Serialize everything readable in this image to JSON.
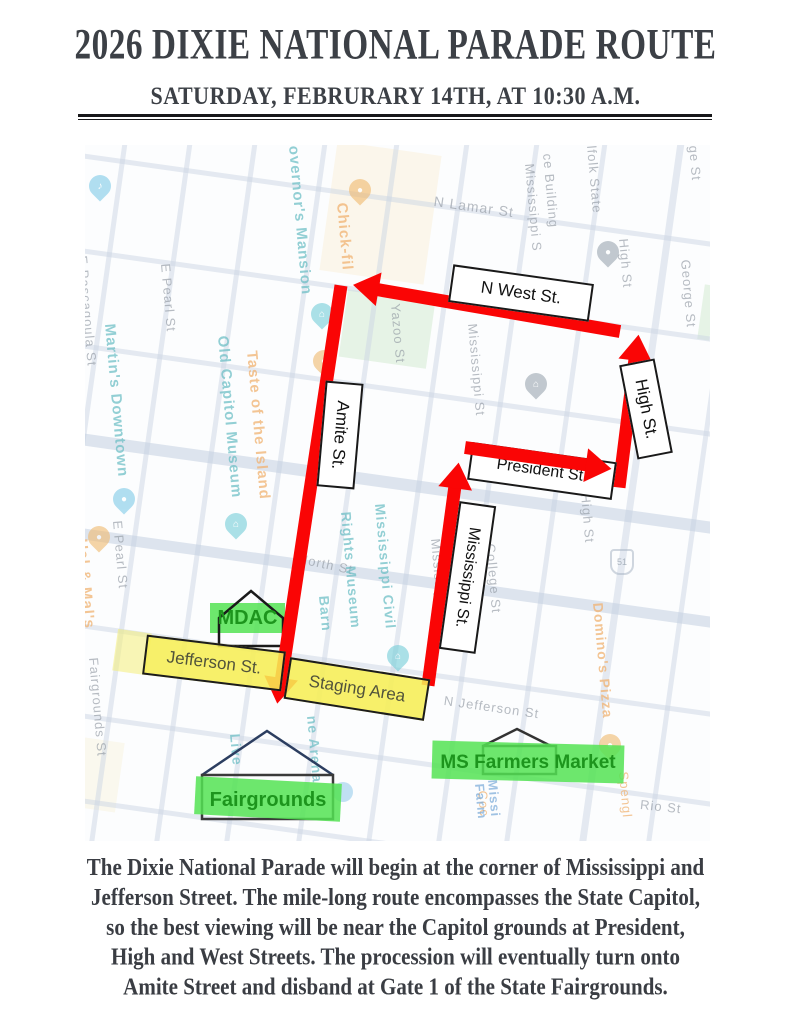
{
  "header": {
    "title": "2026 DIXIE NATIONAL PARADE ROUTE",
    "subtitle": "SATURDAY, FEBRURARY 14TH, AT 10:30 A.M."
  },
  "map": {
    "route_boxes": {
      "n_west": "N West St.",
      "high": "High St.",
      "president": "President St.",
      "amite": "Amite St.",
      "mississippi": "Mississippi St."
    },
    "staging": {
      "jefferson": "Jefferson St.",
      "staging_area": "Staging Area"
    },
    "landmarks": {
      "mdac": "MDAC",
      "fairgrounds": "Fairgrounds",
      "ms_farmers_market": "MS Farmers Market"
    },
    "street_labels": {
      "n_lamar": "N Lamar St",
      "e_pascagoula": "E Pascagoula St",
      "e_pearl": "E Pearl St",
      "yazoo": "Yazoo St",
      "mississippi_s": "Mississippi S",
      "mississippi_st": "Mississippi St",
      "north_st": "North St",
      "college_st": "College St",
      "high_st": "High St",
      "george_st": "George St",
      "george_partial": "ge St",
      "n_jefferson": "N Jefferson St",
      "rio_st": "Rio St",
      "woolfolk_1": "lfolk State",
      "woolfolk_2": "ce Building",
      "fairgrounds_st": "Fairgrounds St",
      "highway_51": "51"
    },
    "poi_labels": {
      "governors_mansion": "overnor's Mansion",
      "chick_fil_a": "Chick-fil",
      "martins_downtown": "Martin's Downtown",
      "old_capitol_museum": "Old Capitol Museum",
      "taste_of_the_island": "Taste of the Island",
      "hal_and_mals": "Hal & Mal's",
      "civil_rights_1": "Mississippi Civil",
      "civil_rights_2": "Rights Museum",
      "barn": "Barn",
      "arena": "ne Arena",
      "live": "Live",
      "dominos_pizza": "Domino's Pizza",
      "spengler": "Spengl",
      "coca": "Coc",
      "farmers_1": "Missi",
      "farmers_2": "Farm"
    }
  },
  "footer": {
    "lines": [
      "The Dixie National Parade will begin at the corner of Mississippi and",
      "Jefferson Street. The mile-long route encompasses the State Capitol,",
      "so the best viewing will be near the Capitol grounds at President,",
      "High and West Streets. The procession will eventually turn onto",
      "Amite Street and disband at Gate 1 of the State Fairgrounds."
    ]
  },
  "colors": {
    "route_red": "#fa0505",
    "highlight_yellow": "#f6ee5d",
    "highlight_green": "#54e354",
    "landmark_text_green": "#1d951d",
    "title_text": "#3c4046"
  }
}
